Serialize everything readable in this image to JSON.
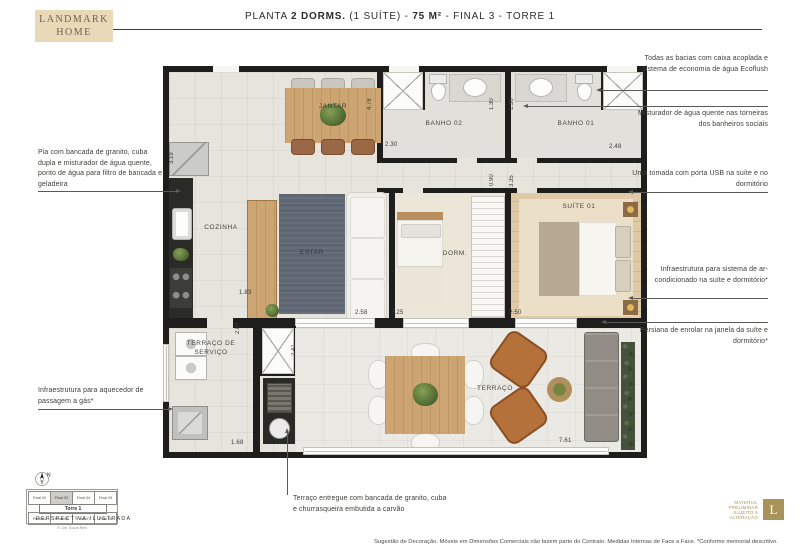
{
  "logo": {
    "line1": "LANDMARK",
    "line2": "HOME"
  },
  "header": {
    "title_p1": "PLANTA ",
    "title_b1": "2 DORMS.",
    "title_p2": " (1 SUÍTE) - ",
    "title_b2": "75 M²",
    "title_p3": " - FINAL 3 - TORRE 1"
  },
  "plan": {
    "rooms": {
      "jantar": "JANTAR",
      "banho02": "BANHO 02",
      "banho01": "BANHO 01",
      "cozinha": "COZINHA",
      "estar": "ESTAR",
      "dorm": "DORM.",
      "suite": "SUÍTE 01",
      "servico_l1": "TERRAÇO DE",
      "servico_l2": "SERVIÇO",
      "terraco": "TERRAÇO"
    },
    "dims": {
      "d319": "3.19",
      "d478": "4.78",
      "d230": "2.30",
      "d130a": "1.30",
      "d130b": "1.30",
      "d248": "2.48",
      "d090": "0.90",
      "d335": "3.35",
      "d183": "1.83",
      "d284": "2.84",
      "d258": "2.58",
      "d225": "2.25",
      "d250": "2.50",
      "d241": "2.41",
      "d168": "1.68",
      "d761": "7.61"
    }
  },
  "annotations": {
    "left1": "Pia com bancada de granito, cuba dupla e misturador de água quente, ponto de água para filtro de bancada e geladeira",
    "left2": "Infraestrutura para aquecedor de passagem a gás*",
    "bottom": "Terraço entregue com bancada de granito, cuba e churrasqueira embutida a carvão",
    "right1": "Todas as bacias com caixa acoplada e sistema de economia de água Ecoflush",
    "right2": "Misturador de água quente nas torneiras dos banheiros sociais",
    "right3": "Uma tomada com porta USB na suíte e no dormitório",
    "right4": "Infraestrutura para sistema de ar-condicionado na suíte e dormitório*",
    "right5": "Persiana de enrolar na janela da suíte e dormitório*"
  },
  "keyplan": {
    "torre": "Torre 1",
    "street": "R. Cel. Souza Reis",
    "units_top": [
      "Final 02",
      "Final 03",
      "Final 04",
      "Final 05"
    ],
    "units_bottom": [
      "Final 01",
      "Final 08",
      "Final 07",
      "Final 06"
    ],
    "highlighted_unit": "Final 03"
  },
  "footer": {
    "perspectiva": "PERSPECTIVA ILUSTRADA",
    "disclaimer": "Sugestão de Decoração. Móveis em Dimensões Comerciais não fazem parte do Contrato. Medidas Internas de Face a Face. *Conforme memorial descritivo.",
    "material": [
      "MATERIAL",
      "PRELIMINAR",
      "SUJEITO A",
      "ALTERAÇÃO"
    ],
    "logo_letter": "L"
  },
  "colors": {
    "logo_bg": "#ead9b8",
    "gold": "#a5914f",
    "wall": "#1e1e1c",
    "rug": "#5d6672",
    "wood": "#cda572",
    "lounge_chair": "#b5713a"
  }
}
